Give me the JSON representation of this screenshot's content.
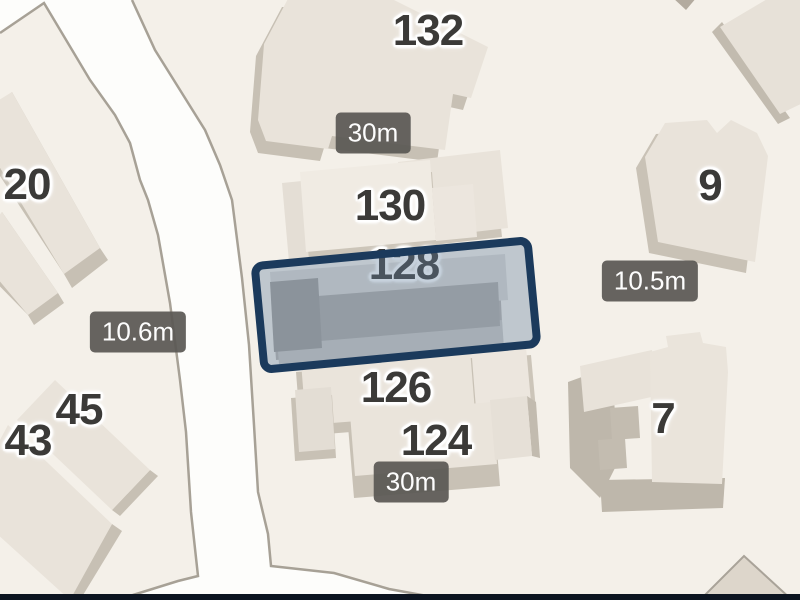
{
  "map": {
    "selected_building": "128",
    "house_numbers": [
      {
        "label": "132"
      },
      {
        "label": "130"
      },
      {
        "label": "128"
      },
      {
        "label": "126"
      },
      {
        "label": "124"
      },
      {
        "label": "20"
      },
      {
        "label": "45"
      },
      {
        "label": "43"
      },
      {
        "label": "9"
      },
      {
        "label": "7"
      }
    ],
    "measurements": [
      {
        "label": "30m"
      },
      {
        "label": "10.6m"
      },
      {
        "label": "10.5m"
      },
      {
        "label": "30m"
      }
    ],
    "colors": {
      "background": "#f4f0e9",
      "road": "#fdfdfb",
      "road_edge": "#a7a196",
      "building_roof": "#e9e3da",
      "building_shade": "#c7c0b4",
      "selection_border": "#1b3a5c",
      "selection_fill": "rgba(100,130,160,0.37)",
      "badge_background": "rgba(90,88,84,0.93)",
      "badge_text": "#fdfdfd",
      "label_text": "#3b3a38",
      "bottom_bar": "#0c1420"
    }
  }
}
